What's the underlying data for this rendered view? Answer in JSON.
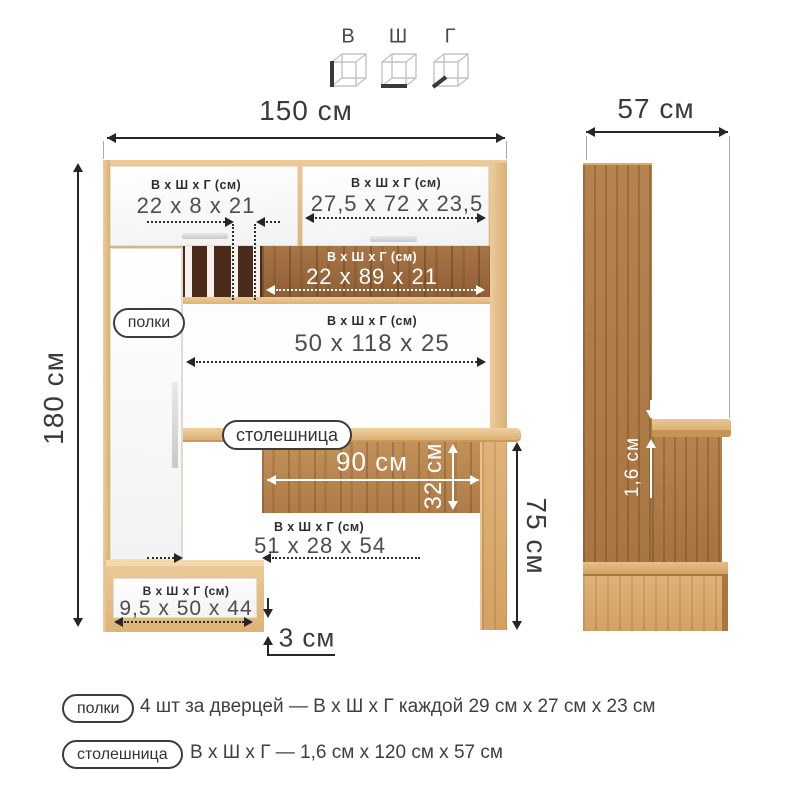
{
  "axis_legend": {
    "height_label": "В",
    "width_label": "Ш",
    "depth_label": "Г"
  },
  "dims_header": "В х Ш х Г (см)",
  "front": {
    "total_width": "150 см",
    "total_height": "180 см",
    "top_left_door": "22 х 8 х 21",
    "top_right_door": "27,5 х 72 х 23,5",
    "shelf_band": "22 х 89 х 21",
    "middle_niche": "50 х 118 х 25",
    "desk_width": "90 см",
    "desk_apron_height": "32 см",
    "desk_height": "75 см",
    "under_desk_niche": "51 х 28 х 54",
    "drawer": "9,5 х 50 х 44",
    "plinth_gap": "3 см"
  },
  "side": {
    "depth": "57 см",
    "top_thickness": "1,6 см"
  },
  "callouts": {
    "shelves": "полки",
    "tabletop": "столешница"
  },
  "legend": [
    {
      "label": "полки",
      "text": "4 шт за дверцей — В х Ш х Г каждой 29 см х 27 см х 23 см"
    },
    {
      "label": "столешница",
      "text": "В х Ш х Г — 1,6 см х 120 см х 57 см"
    }
  ],
  "colors": {
    "oak_light": "#e2bc85",
    "wood_medium": "#b9854f",
    "wood_dark": "#4a2a18",
    "text_dark": "#3a3a3a"
  }
}
